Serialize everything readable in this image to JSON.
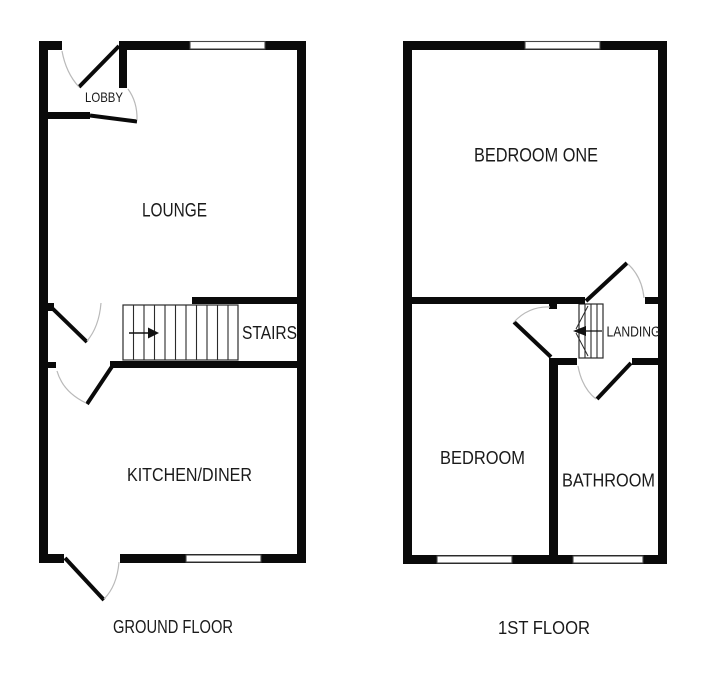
{
  "colors": {
    "wall": "#0a0a0a",
    "background": "#ffffff",
    "door_arc": "#b9b9b9",
    "window_frame": "#474747",
    "stair_outline": "#2b2b2b"
  },
  "ground_floor": {
    "caption": "GROUND FLOOR",
    "rooms": {
      "lobby": "LOBBY",
      "lounge": "LOUNGE",
      "stairs": "STAIRS",
      "kitchen_diner": "KITCHEN/DINER"
    }
  },
  "first_floor": {
    "caption": "1ST FLOOR",
    "rooms": {
      "bedroom_one": "BEDROOM ONE",
      "landing": "LANDING",
      "bedroom": "BEDROOM",
      "bathroom": "BATHROOM"
    }
  }
}
